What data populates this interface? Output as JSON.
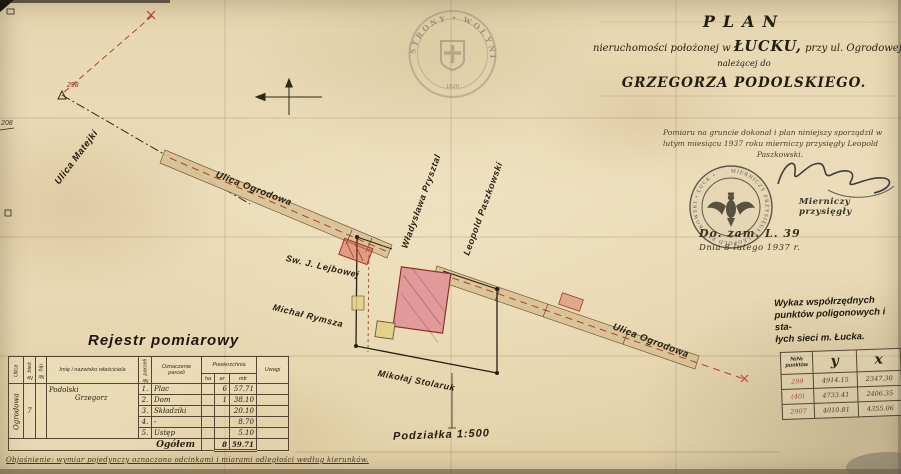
{
  "watermark": {
    "ring_text": "STRONY • WOŁYNIE",
    "year": "1920"
  },
  "title_block": {
    "line1": "PLAN",
    "line2_pre": "nieruchomości położonej w",
    "line2_city": "ŁUCKU,",
    "line2_post": "przy ul. Ogrodowej,",
    "line3": "należącej do",
    "line4": "GRZEGORZA PODOLSKIEGO."
  },
  "attestation": {
    "line1": "Pomiaru na gruncie dokonał i plan niniejszy sporządził w",
    "line2": "lutym miesiącu 1937 roku mierniczy przysięgły Leopold",
    "line3": "Paszkowski."
  },
  "official_seal": {
    "ring_text": "MIERNICZY PRZYSIĘGŁY LEOPOLD PASZKOWSKI • ŁUCK •"
  },
  "signature": {
    "caption": "Mierniczy przysięgły"
  },
  "case_ref": {
    "line1": "Do. zam. L. 39",
    "line2": "Dnia 8 lutego 1937 r."
  },
  "map": {
    "labels": {
      "ulica_matejki": "Ulica Matejki",
      "ulica_ogrodowa_upper": "Ulica Ogrodowa",
      "ulica_ogrodowa_lower": "Ulica Ogrodowa",
      "wladyslawa": "Władysława Prysztal",
      "leopold_paszkowski": "Leopold Paszkowski",
      "lejbowej": "Sw. J. Lejbowej",
      "michal_rymsza": "Michał Rymsza",
      "mikolaj_stolaruk": "Mikołaj Stolaruk"
    },
    "point_208": "208",
    "point_298": "298",
    "scale": "Podziałka 1:500"
  },
  "register": {
    "title": "Rejestr pomiarowy",
    "headers": {
      "ulica": "Ulica",
      "nr_biez": "№ bież.",
      "nr_hip": "№ hip.",
      "owner": "Imię i nazwisko właściciela",
      "nr_parc": "№ parceli",
      "oznaczenie": "Oznaczenie parceli",
      "powierzchnia": "Powierzchnia",
      "ha": "ha",
      "ar": "ar",
      "mtr": "mtr",
      "uwagi": "Uwagi"
    },
    "street": "Ogrodowa",
    "house_no": "7",
    "owner_line1": "Podolski",
    "owner_line2": "Grzegorz",
    "rows": [
      {
        "no": "1.",
        "name": "Plac",
        "ha": "",
        "ar": "6",
        "mtr": "57.71"
      },
      {
        "no": "2.",
        "name": "Dom",
        "ha": "",
        "ar": "1",
        "mtr": "38.10"
      },
      {
        "no": "3.",
        "name": "Składziki",
        "ha": "",
        "ar": "",
        "mtr": "20.10"
      },
      {
        "no": "4.",
        "name": "-",
        "ha": "",
        "ar": "",
        "mtr": "8.70"
      },
      {
        "no": "5.",
        "name": "Ustęp",
        "ha": "",
        "ar": "",
        "mtr": "5.10"
      }
    ],
    "total_label": "Ogółem",
    "total_ha": "",
    "total_ar": "8",
    "total_mtr": "59.71"
  },
  "coords": {
    "title_line1": "Wykaz współrzędnych",
    "title_line2": "punktów poligonowych i sta-",
    "title_line3": "łych sieci m. Łucka.",
    "headers": {
      "point": "№№ punktów",
      "y": "y",
      "x": "x"
    },
    "rows": [
      {
        "point": "299",
        "y": "4914.15",
        "x": "2347.30"
      },
      {
        "point": "(40)",
        "y": "4733.41",
        "x": "2406.35"
      },
      {
        "point": "2907",
        "y": "4010.81",
        "x": "4355.06"
      }
    ]
  },
  "footnote": "Objaśnienie: wymiar pojedynczy oznaczono odcinkami i miarami odległości według kierunków."
}
